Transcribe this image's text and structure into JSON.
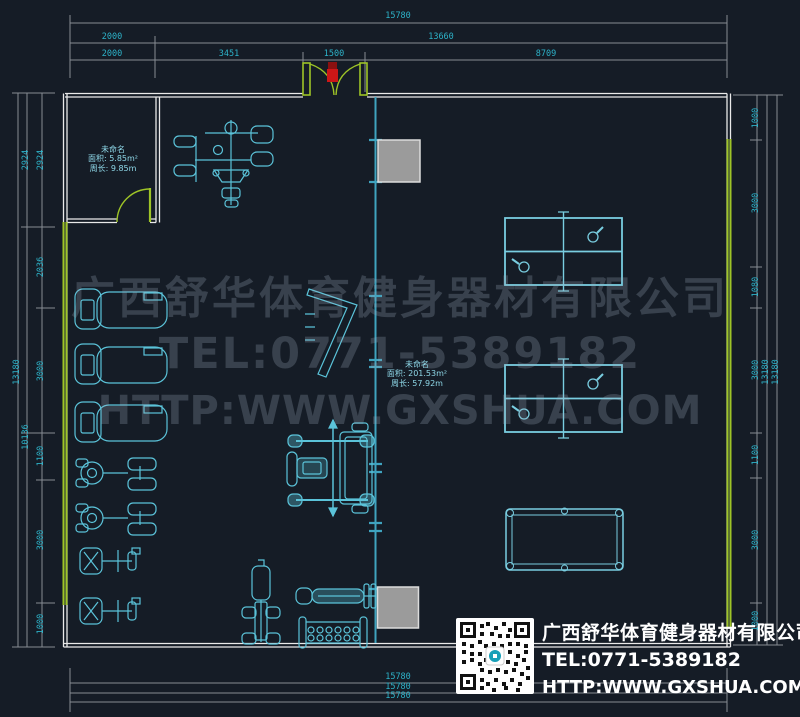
{
  "dims": {
    "top": [
      "15780",
      "2000",
      "13660",
      "2000",
      "3451",
      "1500",
      "8709"
    ],
    "bottom": [
      "15780",
      "15780",
      "15780"
    ],
    "left": [
      "2924",
      "2924",
      "2036",
      "13180",
      "3000",
      "10136",
      "1100",
      "3000",
      "1000"
    ],
    "right": [
      "1000",
      "3000",
      "1080",
      "3000",
      "13180",
      "13180",
      "1100",
      "3000",
      "1000"
    ]
  },
  "room_small": {
    "name": "未命名",
    "area": "面积: 5.85m²",
    "perimeter": "周长: 9.85m"
  },
  "room_main": {
    "name": "未命名",
    "area": "面积: 201.53m²",
    "perimeter": "周长: 57.92m"
  },
  "watermark": {
    "company": "广西舒华体育健身器材有限公司",
    "tel": "TEL:0771-5389182",
    "url": "HTTP:WWW.GXSHUA.COM"
  },
  "footer": {
    "company": "广西舒华体育健身器材有限公司",
    "tel": "TEL:0771-5389182",
    "url": "HTTP:WWW.GXSHUA.COM"
  },
  "icons": {
    "qr_code": "qr-code"
  },
  "colors": {
    "background": "#151c26",
    "dim_text": "#2db2c8",
    "dim_line": "#868c93",
    "wall": "#e9e9e9",
    "highlight_green": "#a0c52a",
    "equipment": "#5bc3d9",
    "door_marker": "#cc1717",
    "column_gray": "#9b9b9b"
  }
}
